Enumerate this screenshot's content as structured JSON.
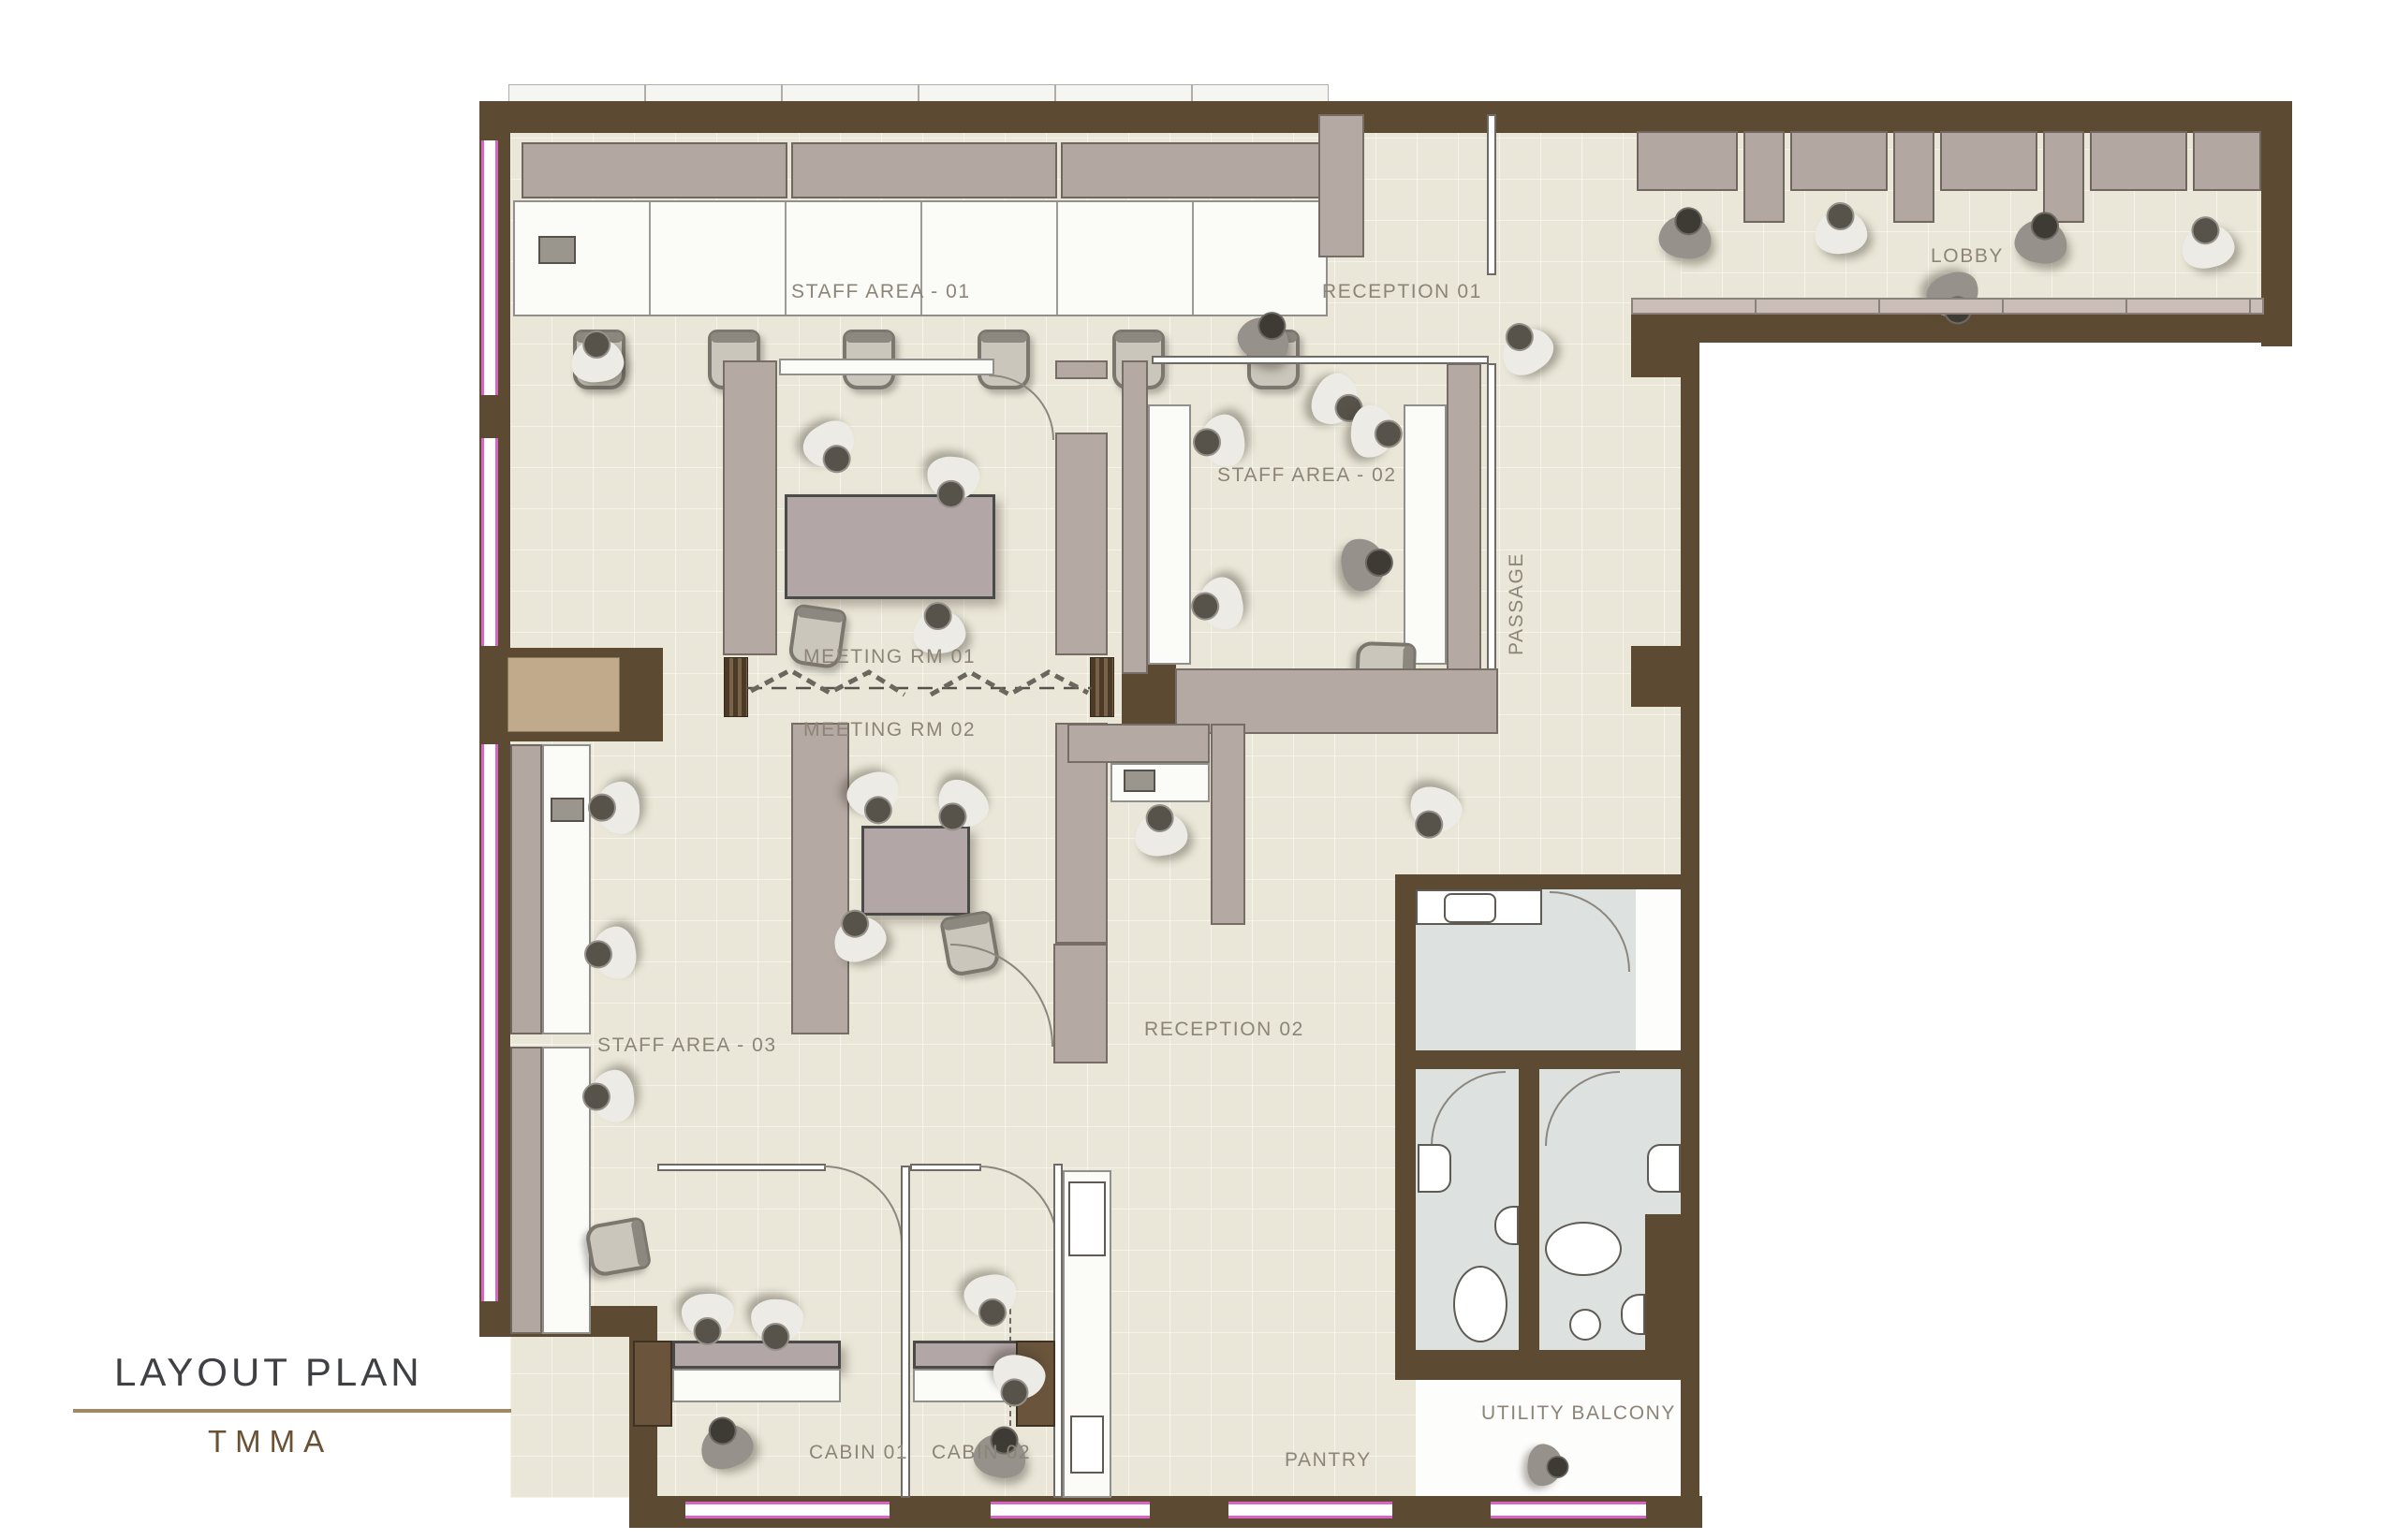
{
  "title_block": {
    "title": "LAYOUT PLAN",
    "subtitle": "TMMA"
  },
  "rooms": {
    "staff_area_01": "STAFF AREA - 01",
    "reception_01": "RECEPTION 01",
    "lobby": "LOBBY",
    "staff_area_02": "STAFF AREA - 02",
    "passage": "PASSAGE",
    "meeting_rm_01": "MEETING RM 01",
    "meeting_rm_02": "MEETING RM 02",
    "reception_02": "RECEPTION 02",
    "staff_area_03": "STAFF AREA - 03",
    "cabin_01": "CABIN 01",
    "cabin_02": "CABIN 02",
    "pantry": "PANTRY",
    "utility_balcony": "UTILITY BALCONY"
  },
  "colors": {
    "wall_brown": "#5d4a33",
    "partition_taupe": "#b5a9a3",
    "floor_cream": "#ebe7d8",
    "wet_area_floor": "#dde1df",
    "window_accent_pink": "#da64c6",
    "niche_tan": "#c0aa8b",
    "title_text": "#3e4043",
    "subtitle_text": "#6b5134",
    "rule_brown": "#a3885f",
    "label_text": "#8d8478"
  }
}
